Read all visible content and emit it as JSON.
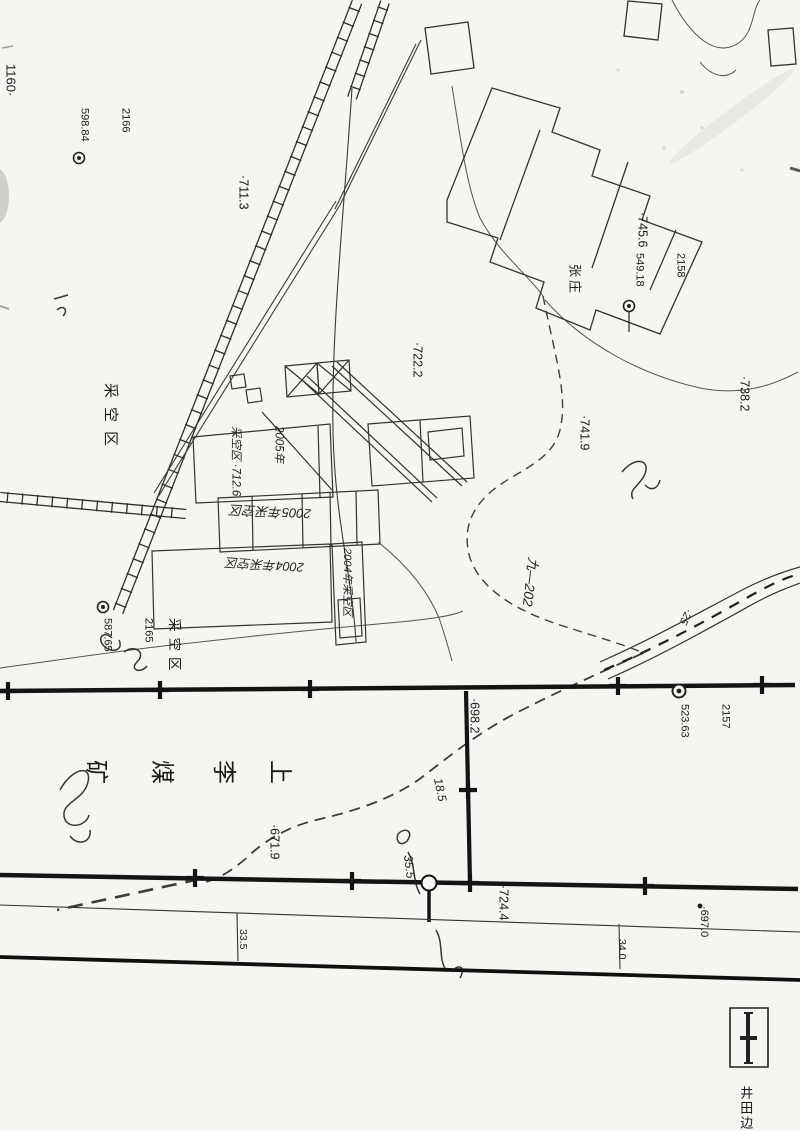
{
  "labels": {
    "corner_grid": "1160·",
    "elev_711": "·711.3",
    "elev_745": "·745.6",
    "elev_722": "·722.2",
    "elev_741": "·741.9",
    "elev_738": "·738.2",
    "elev_698": "·698.2",
    "elev_671": "·671.9",
    "elev_724": "·724.4",
    "elev_697": "·697.0",
    "village": "张庄",
    "goaf_upper": "采空区",
    "goaf_lower": "采空区",
    "mine_name_chars": [
      "上",
      "李",
      "煤",
      "矿"
    ],
    "road_width_left": "33.5",
    "road_width_right": "34.0",
    "legend_boundary": "井田边",
    "hw_2005_line1": "2005年",
    "hw_2005_line2": "采空区 ·712.6",
    "hw_2005_goaf": "2005年采空区",
    "hw_2004_goaf_a": "2004年采空区",
    "hw_2004_goaf_b": "2004年采空区",
    "hw_seam": "九—202",
    "hw_25": "·25",
    "hw_185": "18.5",
    "hw_355": "35.5"
  },
  "benchmarks": [
    {
      "id": "2166",
      "elev": "598.84"
    },
    {
      "id": "2158",
      "elev": "549.18"
    },
    {
      "id": "2165",
      "elev": "587.65"
    },
    {
      "id": "2157",
      "elev": "523.63"
    }
  ]
}
